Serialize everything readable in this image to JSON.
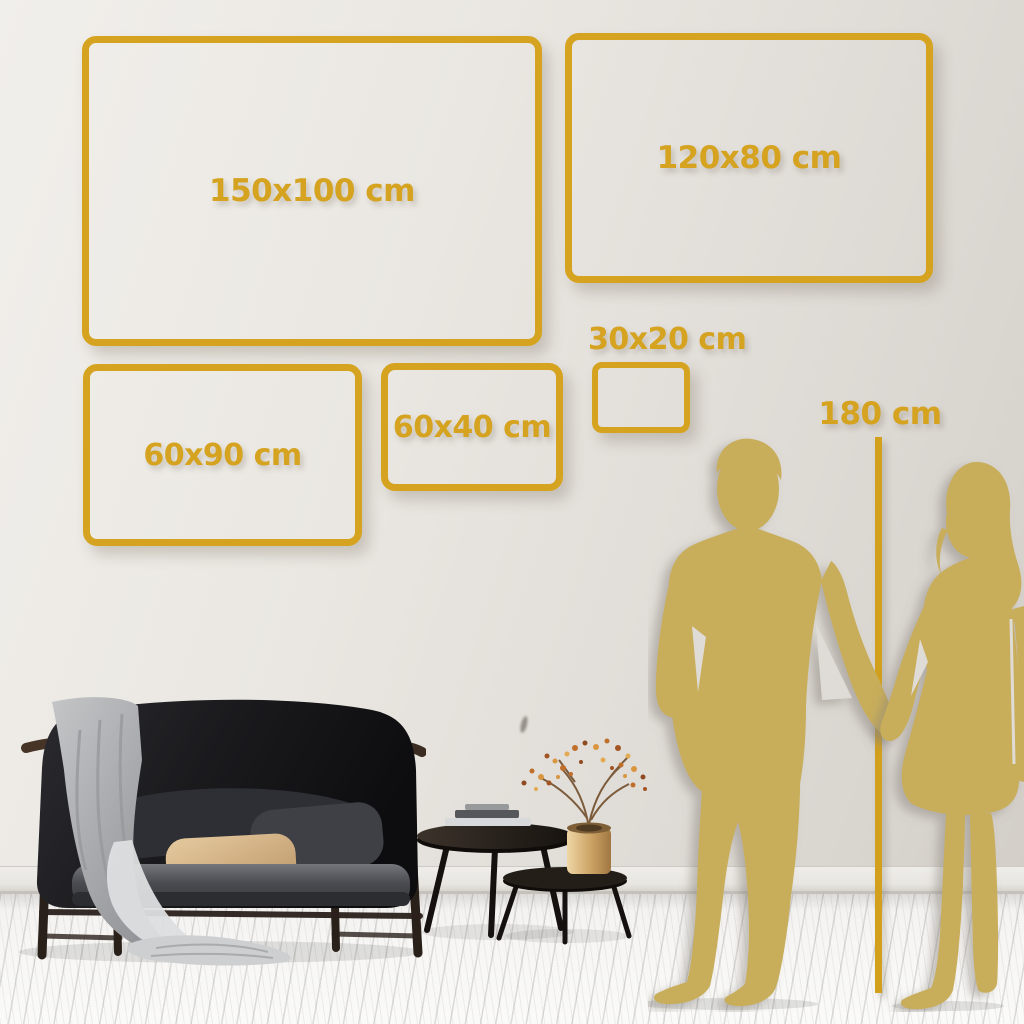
{
  "frames": [
    {
      "name": "150x100",
      "label": "150x100 cm"
    },
    {
      "name": "120x80",
      "label": "120x80 cm"
    },
    {
      "name": "60x90",
      "label": "60x90 cm"
    },
    {
      "name": "60x40",
      "label": "60x40 cm"
    },
    {
      "name": "30x20",
      "label": "30x20 cm"
    }
  ],
  "height_marker": {
    "label": "180 cm"
  },
  "colors": {
    "accent_gold": "#D5A31F",
    "line_gold": "#D2A01C",
    "silhouette_gold": "#C8AD5A",
    "wall": "#E6E3DE",
    "floor": "#F7F6F4"
  }
}
